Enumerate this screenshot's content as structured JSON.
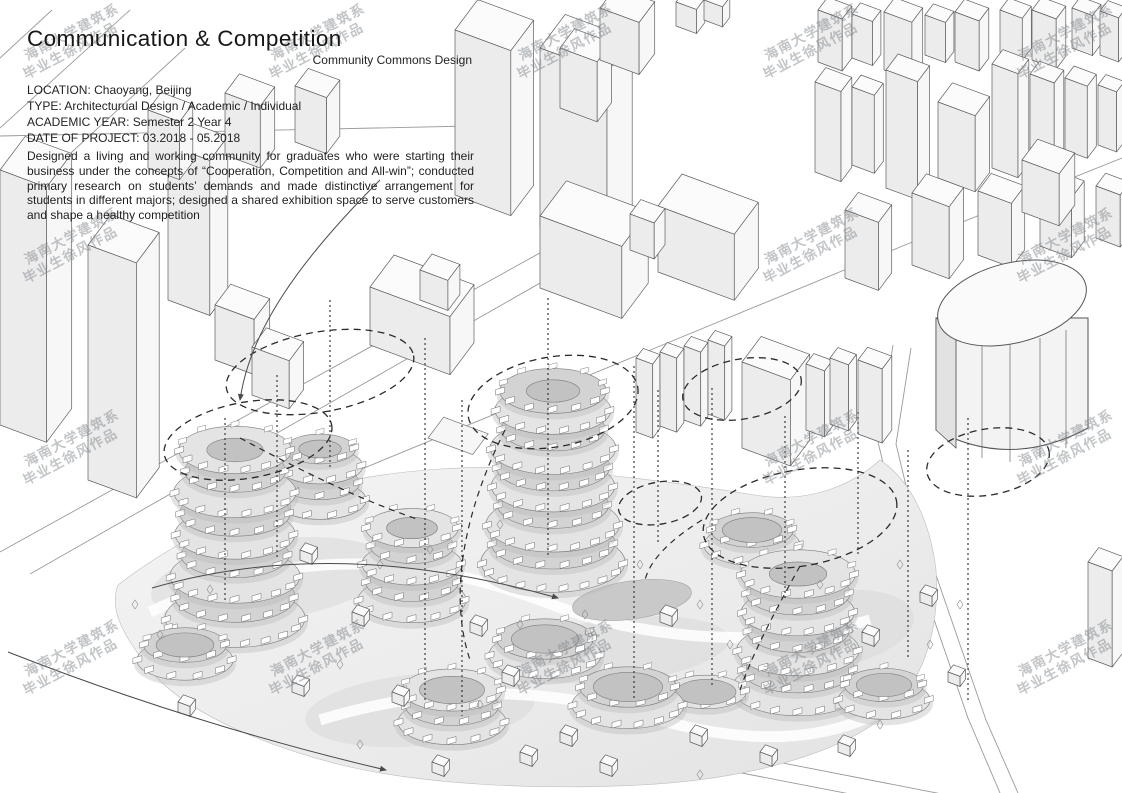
{
  "page": {
    "title": "Communication & Competition",
    "subtitle": "Community Commons Design"
  },
  "meta": {
    "lines": [
      "LOCATION: Chaoyang, Beijing",
      "TYPE: Architecturual Design / Academic / Individual",
      "ACADEMIC YEAR: Semester 2 Year 4",
      "DATE OF PROJECT: 03.2018 - 05.2018"
    ]
  },
  "description": "Designed a living and working community for graduates who were starting their business under the concepts of “Cooperation, Competition and All-win”; conducted primary research on students’ demands and made distinctive arrangement for students in different majors; designed a shared exhibition space to serve customers and shape a healthy competition",
  "watermark": {
    "line1": "海南大学建筑系",
    "line2": "毕业生徐风作品"
  }
}
